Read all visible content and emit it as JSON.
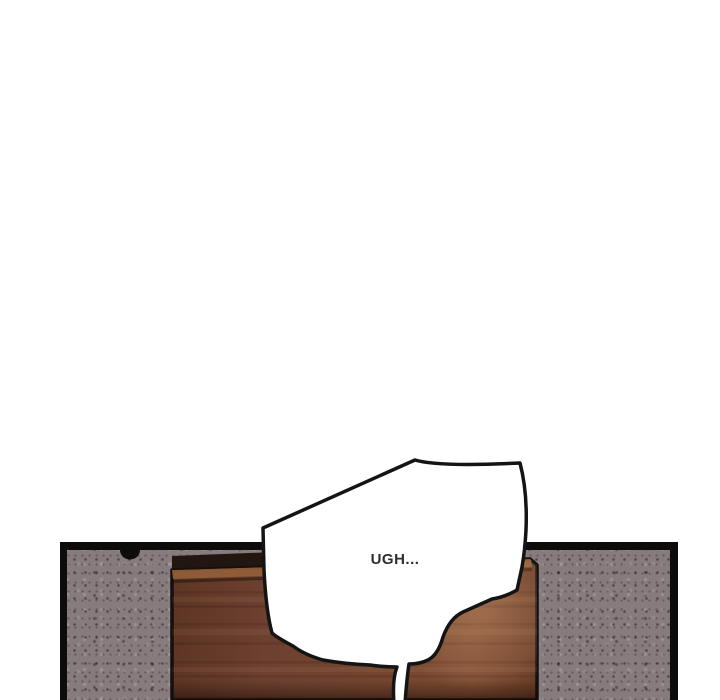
{
  "scene": {
    "type": "webtoon-comic-panel",
    "description": "Wooden door set into a speckled concrete wall inside a black-bordered comic panel; large angular speech bubble with tail running off the bottom edge",
    "dialogue": {
      "text": "UGH..."
    },
    "colors": {
      "page_background": "#ffffff",
      "panel_border": "#0e0c0b",
      "wall": "#867b7d",
      "wall_speckle": "#3c2f31",
      "door_base": "#71412e",
      "door_dark": "#5a3222",
      "door_light": "#9a6a46",
      "door_top_shadow": "#221710",
      "bubble_fill": "#ffffff",
      "bubble_stroke": "#141414",
      "dialogue_text": "#2d2d2d"
    }
  }
}
